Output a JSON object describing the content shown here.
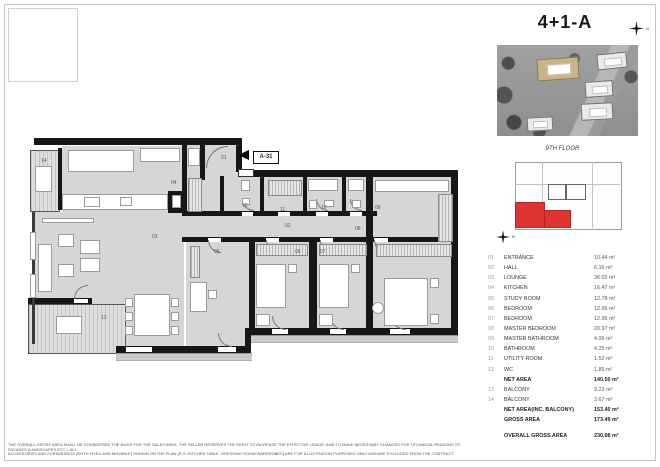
{
  "page": {
    "title": "4+1-A",
    "floor_label": "9TH FLOOR",
    "unit_marker": "A-31",
    "north_letter": "N"
  },
  "colors": {
    "accent_red": "#dd3432",
    "floor_gray": "#d6d6d8",
    "wall_black": "#171717",
    "highlight_building_tan": "#c9b489"
  },
  "plan": {
    "labels": {
      "r01": "01",
      "r02": "02",
      "r03": "03",
      "r04": "04",
      "r05": "05",
      "r06": "06",
      "r07": "07",
      "r08": "08",
      "r09": "09",
      "r10": "10",
      "r11": "11",
      "r12": "12",
      "r13": "13",
      "r14": "14"
    }
  },
  "area_table": {
    "rows": [
      {
        "num": "01",
        "name": "ENTRANCE",
        "area": "10.44 m²",
        "bold": false
      },
      {
        "num": "02",
        "name": "HALL",
        "area": "6.16 m²",
        "bold": false
      },
      {
        "num": "03",
        "name": "LOUNGE",
        "area": "36.02 m²",
        "bold": false
      },
      {
        "num": "04",
        "name": "KITCHEN",
        "area": "16.47 m²",
        "bold": false
      },
      {
        "num": "05",
        "name": "STUDY ROOM",
        "area": "12.78 m²",
        "bold": false
      },
      {
        "num": "06",
        "name": "BEDROOM",
        "area": "12.96 m²",
        "bold": false
      },
      {
        "num": "07",
        "name": "BEDROOM",
        "area": "12.96 m²",
        "bold": false
      },
      {
        "num": "08",
        "name": "MASTER BEDROOM",
        "area": "20.97 m²",
        "bold": false
      },
      {
        "num": "09",
        "name": "MASTER BATHROOM",
        "area": "4.06 m²",
        "bold": false
      },
      {
        "num": "10",
        "name": "BATHROOM",
        "area": "4.25 m²",
        "bold": false
      },
      {
        "num": "11",
        "name": "UTILITY ROOM",
        "area": "1.52 m²",
        "bold": false
      },
      {
        "num": "12",
        "name": "WC",
        "area": "1.89 m²",
        "bold": false
      },
      {
        "num": "",
        "name": "NET AREA",
        "area": "140.50 m²",
        "bold": true
      },
      {
        "num": "13",
        "name": "BALCONY",
        "area": "9.23 m²",
        "bold": false
      },
      {
        "num": "14",
        "name": "BALCONY",
        "area": "3.67 m²",
        "bold": false
      },
      {
        "num": "",
        "name": "NET AREA(INC. BALCONY)",
        "area": "153.40 m²",
        "bold": true
      },
      {
        "num": "",
        "name": "GROSS AREA",
        "area": "173.49 m²",
        "bold": true
      }
    ],
    "overall": {
      "name": "OVERALL GROSS AREA",
      "area": "230.98 m²"
    }
  },
  "disclaimer": {
    "line1": "THE OVERALL GROSS AREA SHALL BE CONSIDERED THE BASIS FOR THE SALES AREA. THE SELLER RESERVES THE RIGHT TO INCREASE THE EFFECTIVE USAGE, AND TO MAKE NECESSARY CHANGES FOR TECHNICAL REASONS TO FACADES (LANDSCAPES ETC.). ALL",
    "line2": "ACCESSORIES AND FURNISHINGS (BOTH FIXED AND MOVABLE) SHOWN ON THE PLAN (E.G. KITCHEN TABLE, DRESSING ROOM WARDROBES) ARE FOR ILLUSTRATION PURPOSES ONLY AND ARE EXCLUDED FROM THE CONTRACT."
  }
}
